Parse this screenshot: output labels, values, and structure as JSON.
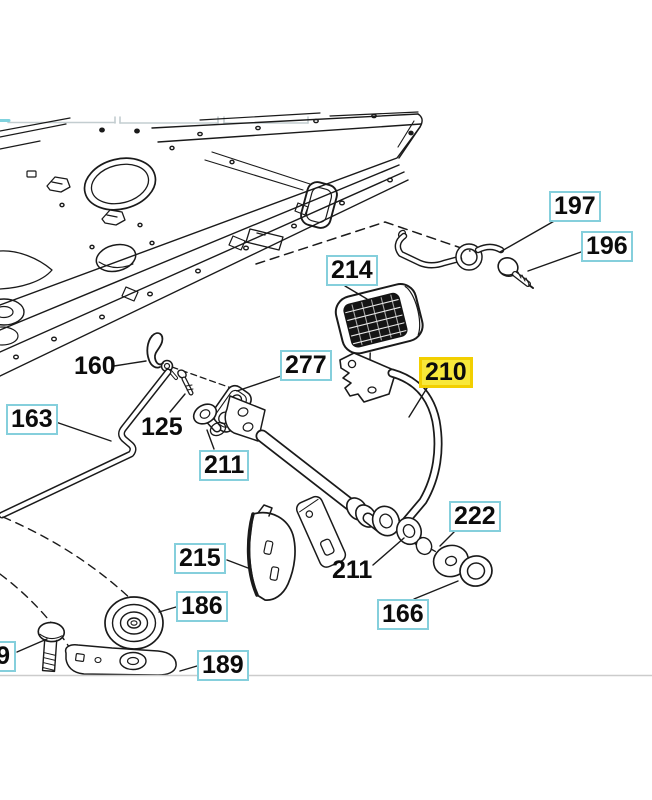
{
  "diagram": {
    "type": "exploded-parts-diagram",
    "selected_part": "210",
    "colors": {
      "callout_border": "#85cfdc",
      "highlight_fill": "#f8e83a",
      "highlight_border": "#f2cf00",
      "line_art": "#1a1a1a",
      "boundary_rule": "#cccccc"
    },
    "callouts": {
      "c197": {
        "label": "197"
      },
      "c196": {
        "label": "196"
      },
      "c214": {
        "label": "214"
      },
      "c210": {
        "label": "210"
      },
      "c277": {
        "label": "277"
      },
      "c160": {
        "label": "160"
      },
      "c163": {
        "label": "163"
      },
      "c125": {
        "label": "125"
      },
      "c211a": {
        "label": "211"
      },
      "c215": {
        "label": "215"
      },
      "c211b": {
        "label": "211"
      },
      "c222": {
        "label": "222"
      },
      "c166": {
        "label": "166"
      },
      "c186": {
        "label": "186"
      },
      "c189": {
        "label": "189"
      },
      "cpartial": {
        "label": "9"
      }
    }
  }
}
